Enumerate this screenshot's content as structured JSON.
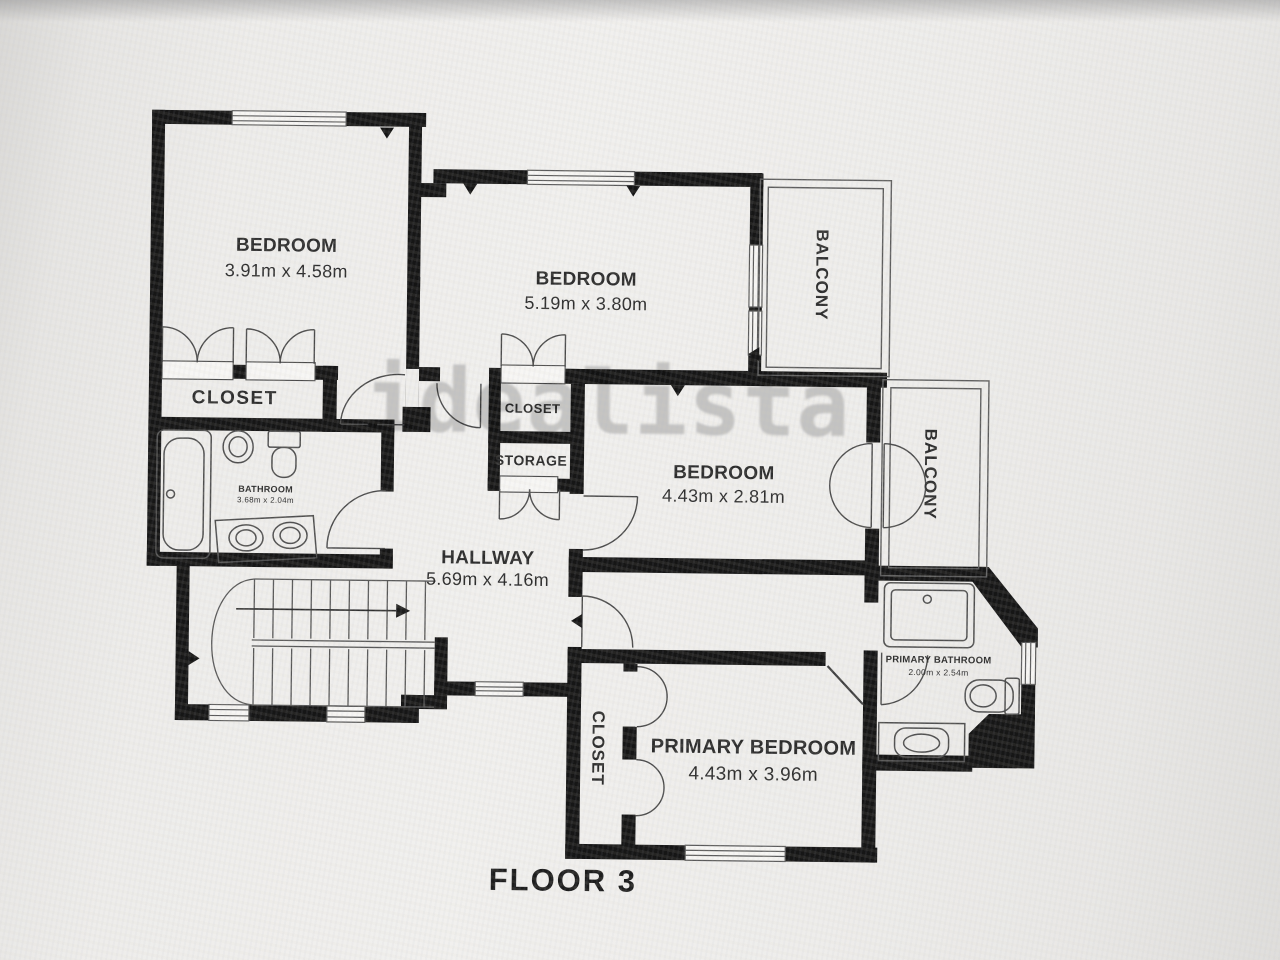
{
  "floorplan": {
    "floor_label": "FLOOR 3",
    "watermark": "idealista",
    "rooms": {
      "bedroom_top_left": {
        "name": "BEDROOM",
        "dims": "3.91m x 4.58m"
      },
      "bedroom_top_middle": {
        "name": "BEDROOM",
        "dims": "5.19m x 3.80m"
      },
      "bedroom_middle_right": {
        "name": "BEDROOM",
        "dims": "4.43m x 2.81m"
      },
      "primary_bedroom": {
        "name": "PRIMARY BEDROOM",
        "dims": "4.43m x 3.96m"
      },
      "hallway": {
        "name": "HALLWAY",
        "dims": "5.69m x 4.16m"
      },
      "bathroom": {
        "name": "BATHROOM",
        "dims": "3.68m x 2.04m"
      },
      "primary_bathroom": {
        "name": "PRIMARY BATHROOM",
        "dims": "2.00m x 2.54m"
      },
      "closet_bedroom": {
        "name": "CLOSET"
      },
      "closet_hall": {
        "name": "CLOSET"
      },
      "storage": {
        "name": "STORAGE"
      },
      "closet_primary": {
        "name": "CLOSET"
      },
      "balcony_top": {
        "name": "BALCONY"
      },
      "balcony_right": {
        "name": "BALCONY"
      }
    }
  }
}
